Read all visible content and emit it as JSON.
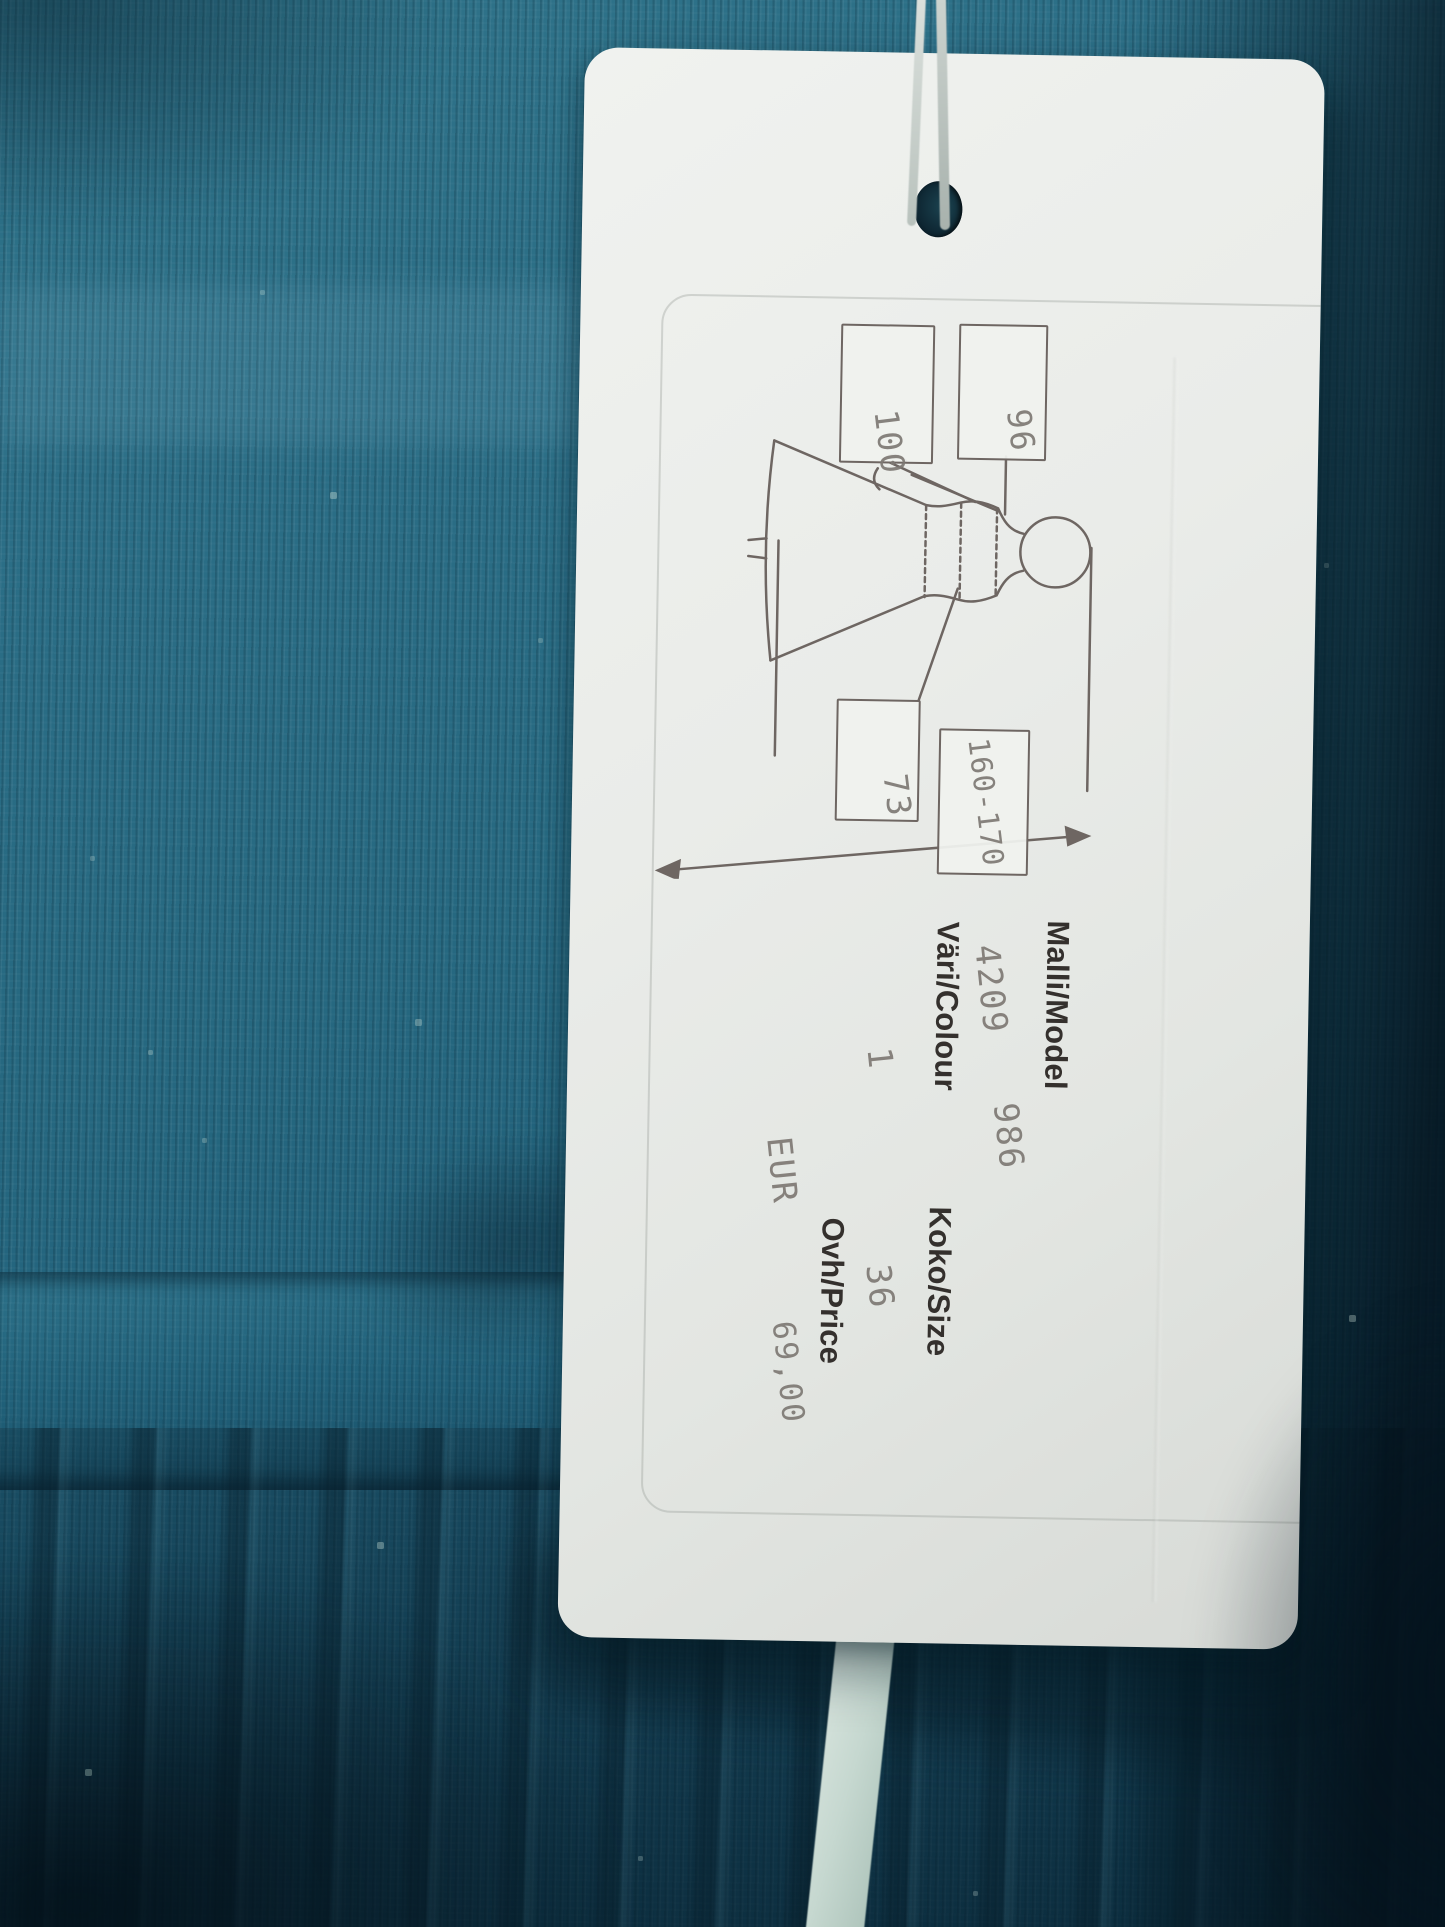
{
  "colors": {
    "fabric_teal": "#266880",
    "fabric_shadow": "#0c2b3a",
    "tag_paper": "#e9ebe8",
    "print_dark": "#34302d",
    "print_dot_matrix": "#7e7974",
    "ribbon_mint": "#cfe0da"
  },
  "tag": {
    "diagram": {
      "boxes": [
        {
          "id": "bust",
          "value": "96"
        },
        {
          "id": "hips",
          "value": "100"
        },
        {
          "id": "waist",
          "value": "73"
        },
        {
          "id": "height",
          "value": "160-170"
        }
      ]
    },
    "fields": [
      {
        "label": "Malli/Model",
        "values": [
          "4209",
          "986"
        ]
      },
      {
        "label": "Väri/Colour",
        "values": [
          "1"
        ]
      },
      {
        "label": "Koko/Size",
        "values": [
          "36"
        ]
      },
      {
        "label": "Ovh/Price",
        "values": [
          "EUR",
          "69,00"
        ]
      }
    ]
  }
}
